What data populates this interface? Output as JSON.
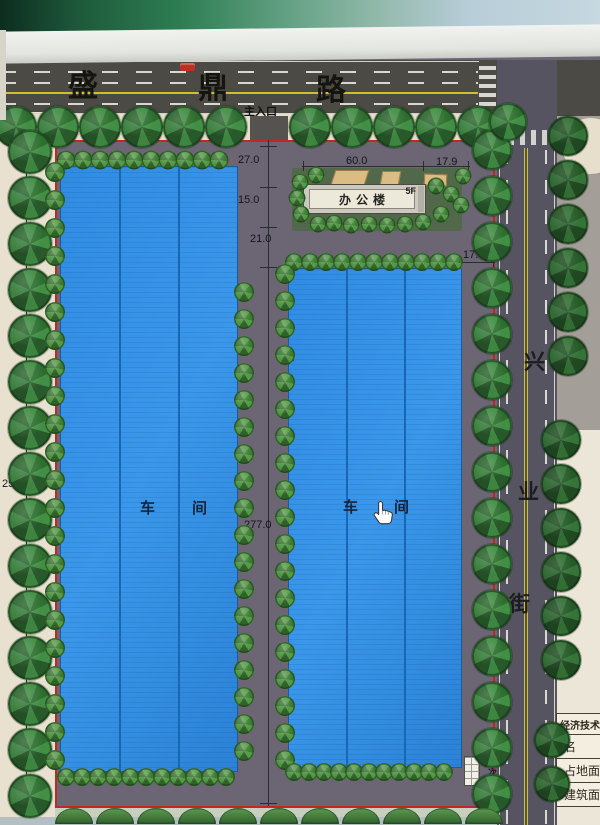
{
  "roads": {
    "top": {
      "name": "盛鼎路",
      "chars": [
        "盛",
        "鼎",
        "路"
      ]
    },
    "right": {
      "name": "兴业街",
      "chars": [
        "兴",
        "业",
        "街"
      ]
    }
  },
  "entrances": {
    "main": "主入口",
    "secondary": "次入口"
  },
  "buildings": {
    "office": {
      "label": "办公楼",
      "floors": "5F"
    },
    "workshop_left": {
      "label": "车间",
      "chars": [
        "车",
        "间"
      ]
    },
    "workshop_right": {
      "label": "车间",
      "chars": [
        "车",
        "间"
      ]
    }
  },
  "dimensions": {
    "d27": "27.0",
    "d15": "15.0",
    "d21": "21.0",
    "d60": "60.0",
    "d17_9": "17.9",
    "d17_3": "17.3",
    "d25": "25.0",
    "d277": "277.0",
    "d20": "20.0"
  },
  "table": {
    "title": "经济技术",
    "rows": [
      "名",
      "占地面",
      "建筑面"
    ]
  },
  "cursor": {
    "type": "hand-pointer"
  },
  "colors": {
    "boundary_red": "#c42626",
    "building_blue": "#2f8ce2",
    "site_gray": "#6b6574",
    "road_dark": "#4b4a45",
    "lane_yellow": "#cfc028",
    "tree_green": "#3a7c3c",
    "sidewalk_cream": "#e9e1cf"
  }
}
